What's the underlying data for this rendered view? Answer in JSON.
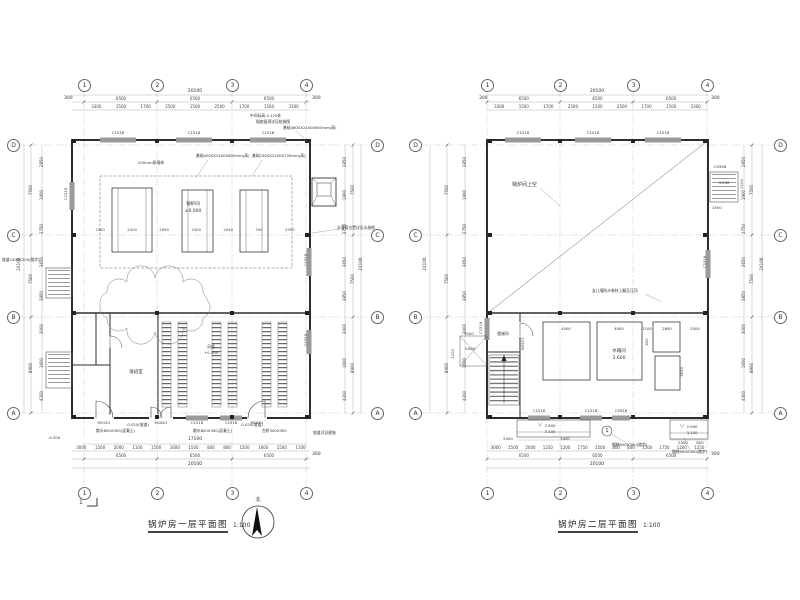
{
  "axes": {
    "cols": [
      "1",
      "2",
      "3",
      "4"
    ],
    "rows_top_to_bottom": [
      "D",
      "C",
      "B",
      "A"
    ],
    "top_total": "20100",
    "top_spans": [
      "6500",
      "6500",
      "6500"
    ],
    "top_detail": [
      "3300",
      "1500",
      "1700",
      "2500",
      "1500",
      "2500",
      "1700",
      "1500",
      "3300"
    ],
    "edge": "300",
    "side_total": "24100",
    "side_spans": [
      "7500",
      "7500",
      "8900"
    ],
    "side_detail": [
      "2850",
      "1900",
      "2750",
      "3650",
      "3850",
      "3000",
      "1600",
      "4300"
    ]
  },
  "plan1": {
    "title": "锅炉房一层平面图",
    "scale": "1:100",
    "bottom_inner": "17100",
    "bottom_detail": [
      "3000",
      "1500",
      "2000",
      "1100",
      "1500",
      "1600",
      "1500",
      "800",
      "800",
      "1500",
      "1600",
      "1500",
      "1100"
    ],
    "hall_dims": [
      "1500",
      "2400",
      "2650",
      "2400",
      "2940",
      "700",
      "2500"
    ],
    "rooms": {
      "hall": "锅炉间",
      "hall_level": "±0.000",
      "duty": "值班室",
      "duct": "风道",
      "duct_level": "+0.300"
    },
    "tags": {
      "c1518": "C1518",
      "m1521": "M1521",
      "m1821": "M1821"
    },
    "annotations": {
      "wall200": "200mm厚墙体",
      "found1": "基础4000X2400X600mm(高)",
      "found2": "基础2300X2200X700mm(高)",
      "found3": "基础4600X2400X600mm(高)",
      "mid_level": "中间标高-0.125处",
      "flue_note": "烟囱留洞详见结施图",
      "drain_note": "水落管位置详见水施图",
      "apron": "散水800X300(混凝土)",
      "ramp": "-0.020(坡道)",
      "steps": "台阶300X300",
      "ramp_side": "坡道1500X300(踏步)",
      "slope_note": "坡道详见建施",
      "lvl_minus03": "-0.300"
    },
    "section_mark": "1",
    "north": "北"
  },
  "plan2": {
    "title": "锅炉房二层平面图",
    "scale": "1:100",
    "bottom_detail": [
      "3000",
      "1500",
      "2000",
      "1250",
      "1200",
      "1750",
      "1500",
      "800",
      "800",
      "1500",
      "1750",
      "1200",
      "1250"
    ],
    "labels": {
      "void": "锅炉间上空",
      "tank": "水箱间",
      "tank_level": "3.600",
      "stair": "楼梯间"
    },
    "dims": {
      "d4000a": "4000",
      "d4000b": "4000",
      "d1100": "1100",
      "d2600": "2600",
      "d2000": "2000",
      "d3600v": "3600",
      "d600": "600",
      "d1500": "1500",
      "d1200": "1200",
      "c_left": "5000",
      "c_left2": "3400",
      "c_right": "2500",
      "c_right2": "800",
      "plat1": "1500",
      "plat2": "2100"
    },
    "tags": {
      "c1518": "C1518",
      "c0918": "C0918",
      "m0921": "M0921",
      "c0906": "C0906"
    },
    "annotations": {
      "parapet": "女儿墙防水卷材上翻至压顶",
      "ladder1": "钢梯500X300(踏步)",
      "ladder2": "钢梯500X300(踏步)"
    },
    "elevations": {
      "plat": "4.000",
      "canopy_a": "2.900",
      "canopy_b": "3.100",
      "landing": "3.600"
    },
    "detail_mark": "1"
  }
}
